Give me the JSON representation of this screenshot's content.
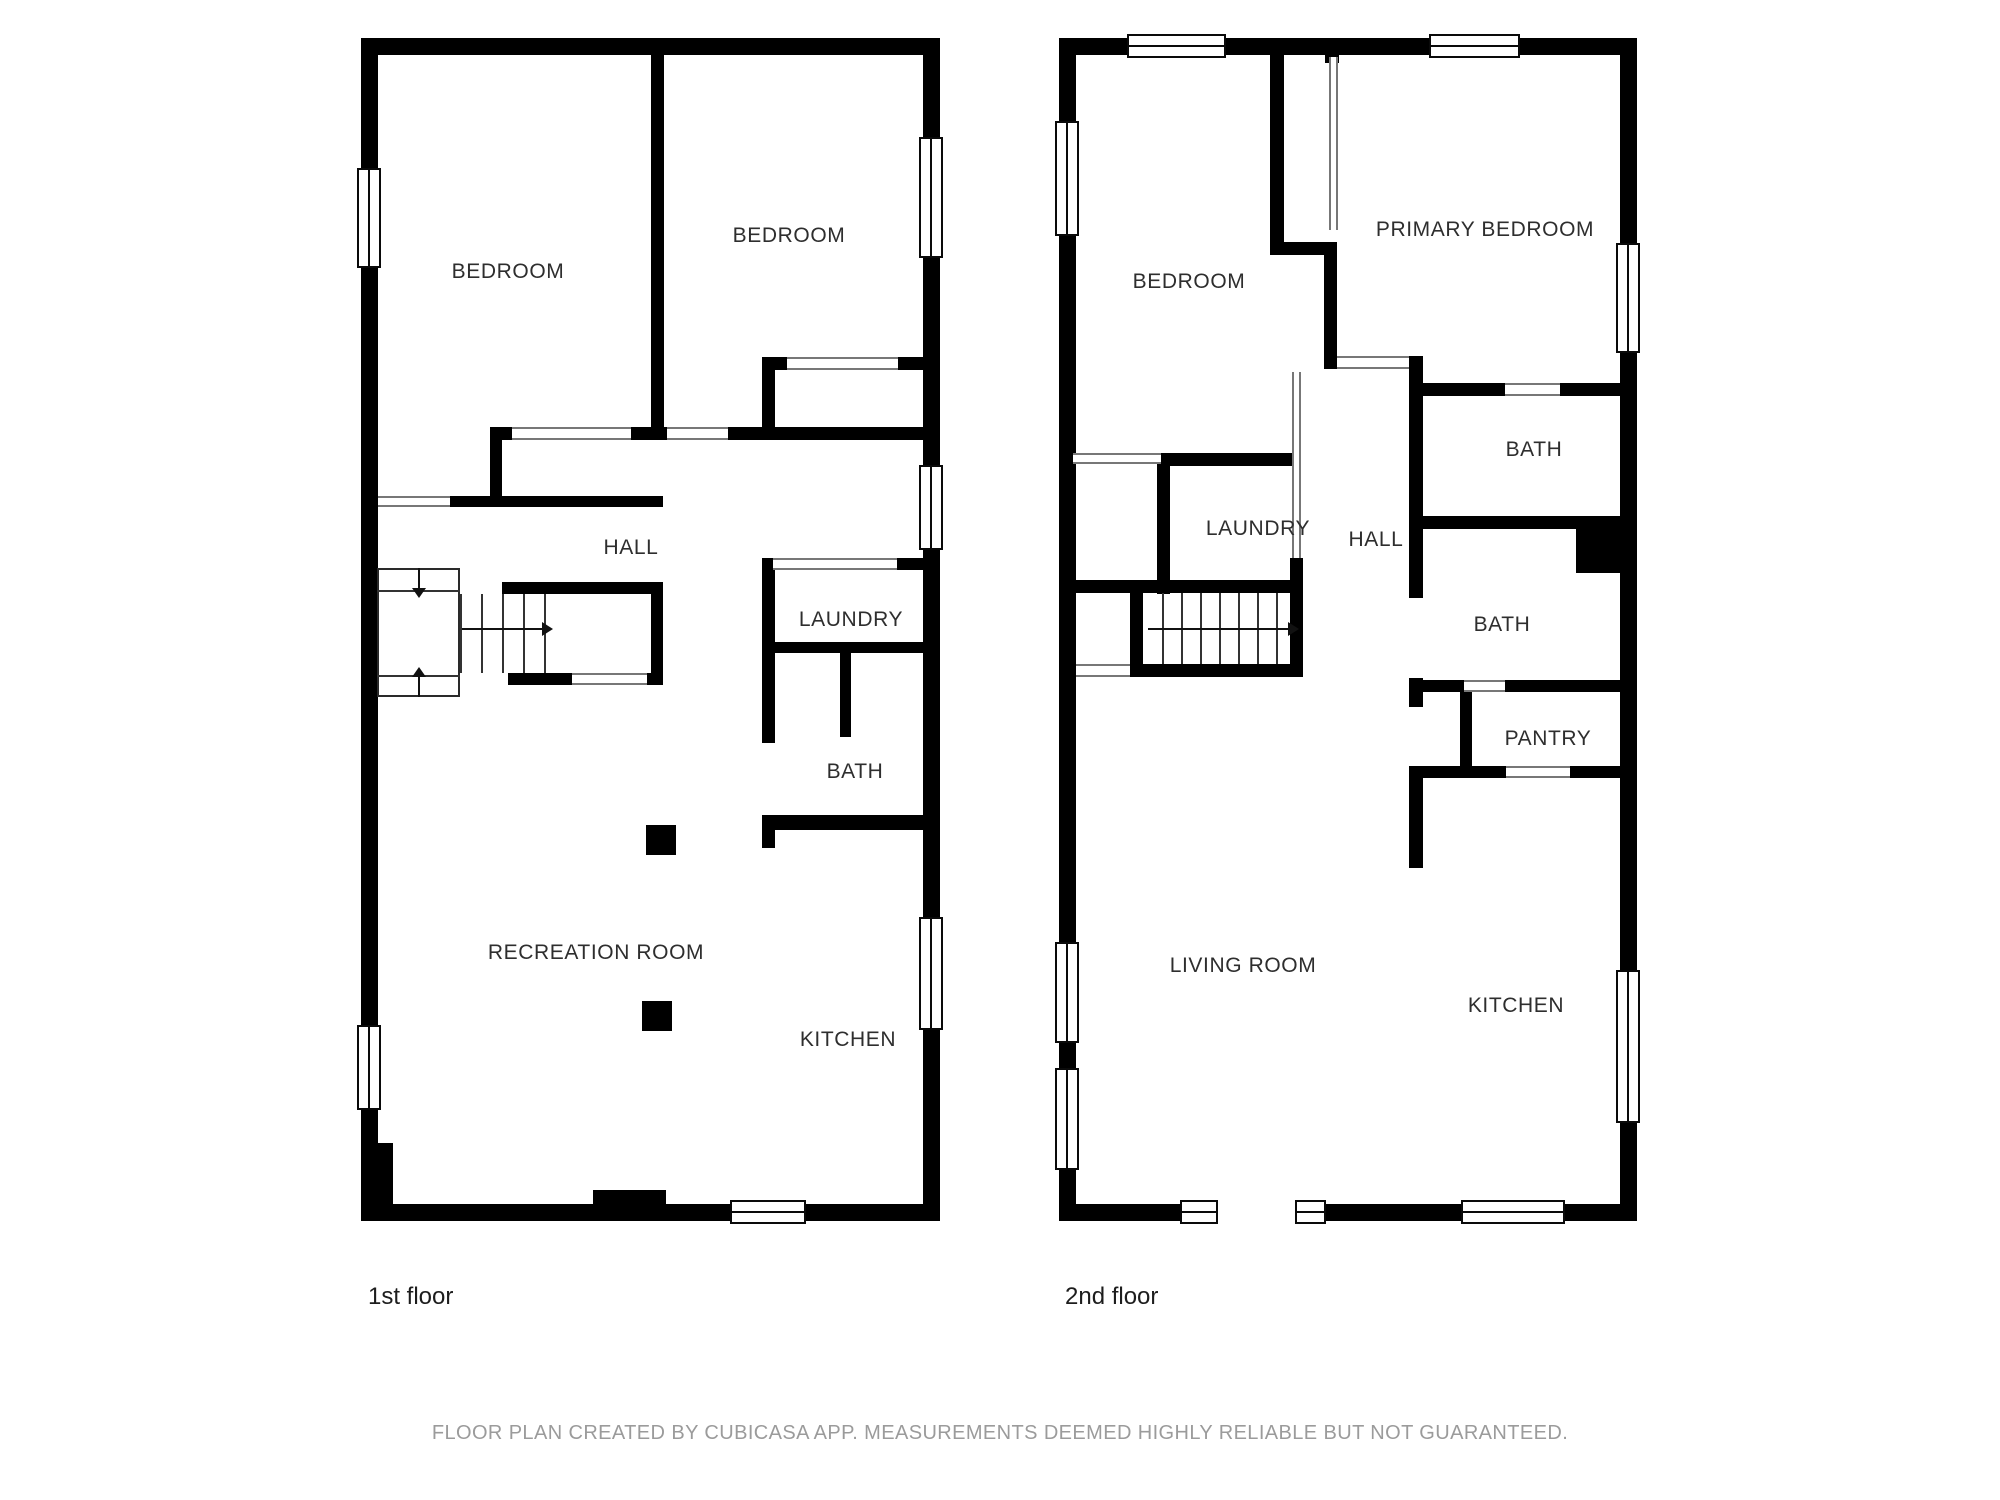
{
  "floor1": {
    "caption": "1st floor",
    "rooms": {
      "bedroom_left": "BEDROOM",
      "bedroom_right": "BEDROOM",
      "hall": "HALL",
      "laundry": "LAUNDRY",
      "bath": "BATH",
      "recreation_room": "RECREATION ROOM",
      "kitchen": "KITCHEN"
    }
  },
  "floor2": {
    "caption": "2nd floor",
    "rooms": {
      "bedroom": "BEDROOM",
      "primary_bedroom": "PRIMARY BEDROOM",
      "bath_upper": "BATH",
      "laundry": "LAUNDRY",
      "hall": "HALL",
      "bath_lower": "BATH",
      "pantry": "PANTRY",
      "living_room": "LIVING ROOM",
      "kitchen": "KITCHEN"
    }
  },
  "footer": {
    "disclaimer": "FLOOR PLAN CREATED BY CUBICASA APP. MEASUREMENTS DEEMED HIGHLY RELIABLE BUT NOT GUARANTEED."
  },
  "colors": {
    "wall": "#000000",
    "room_label": "#2e2e2e",
    "caption": "#1d1d1d",
    "footer_text": "#9b9b9b",
    "background": "#ffffff",
    "opening_line": "#777777"
  }
}
